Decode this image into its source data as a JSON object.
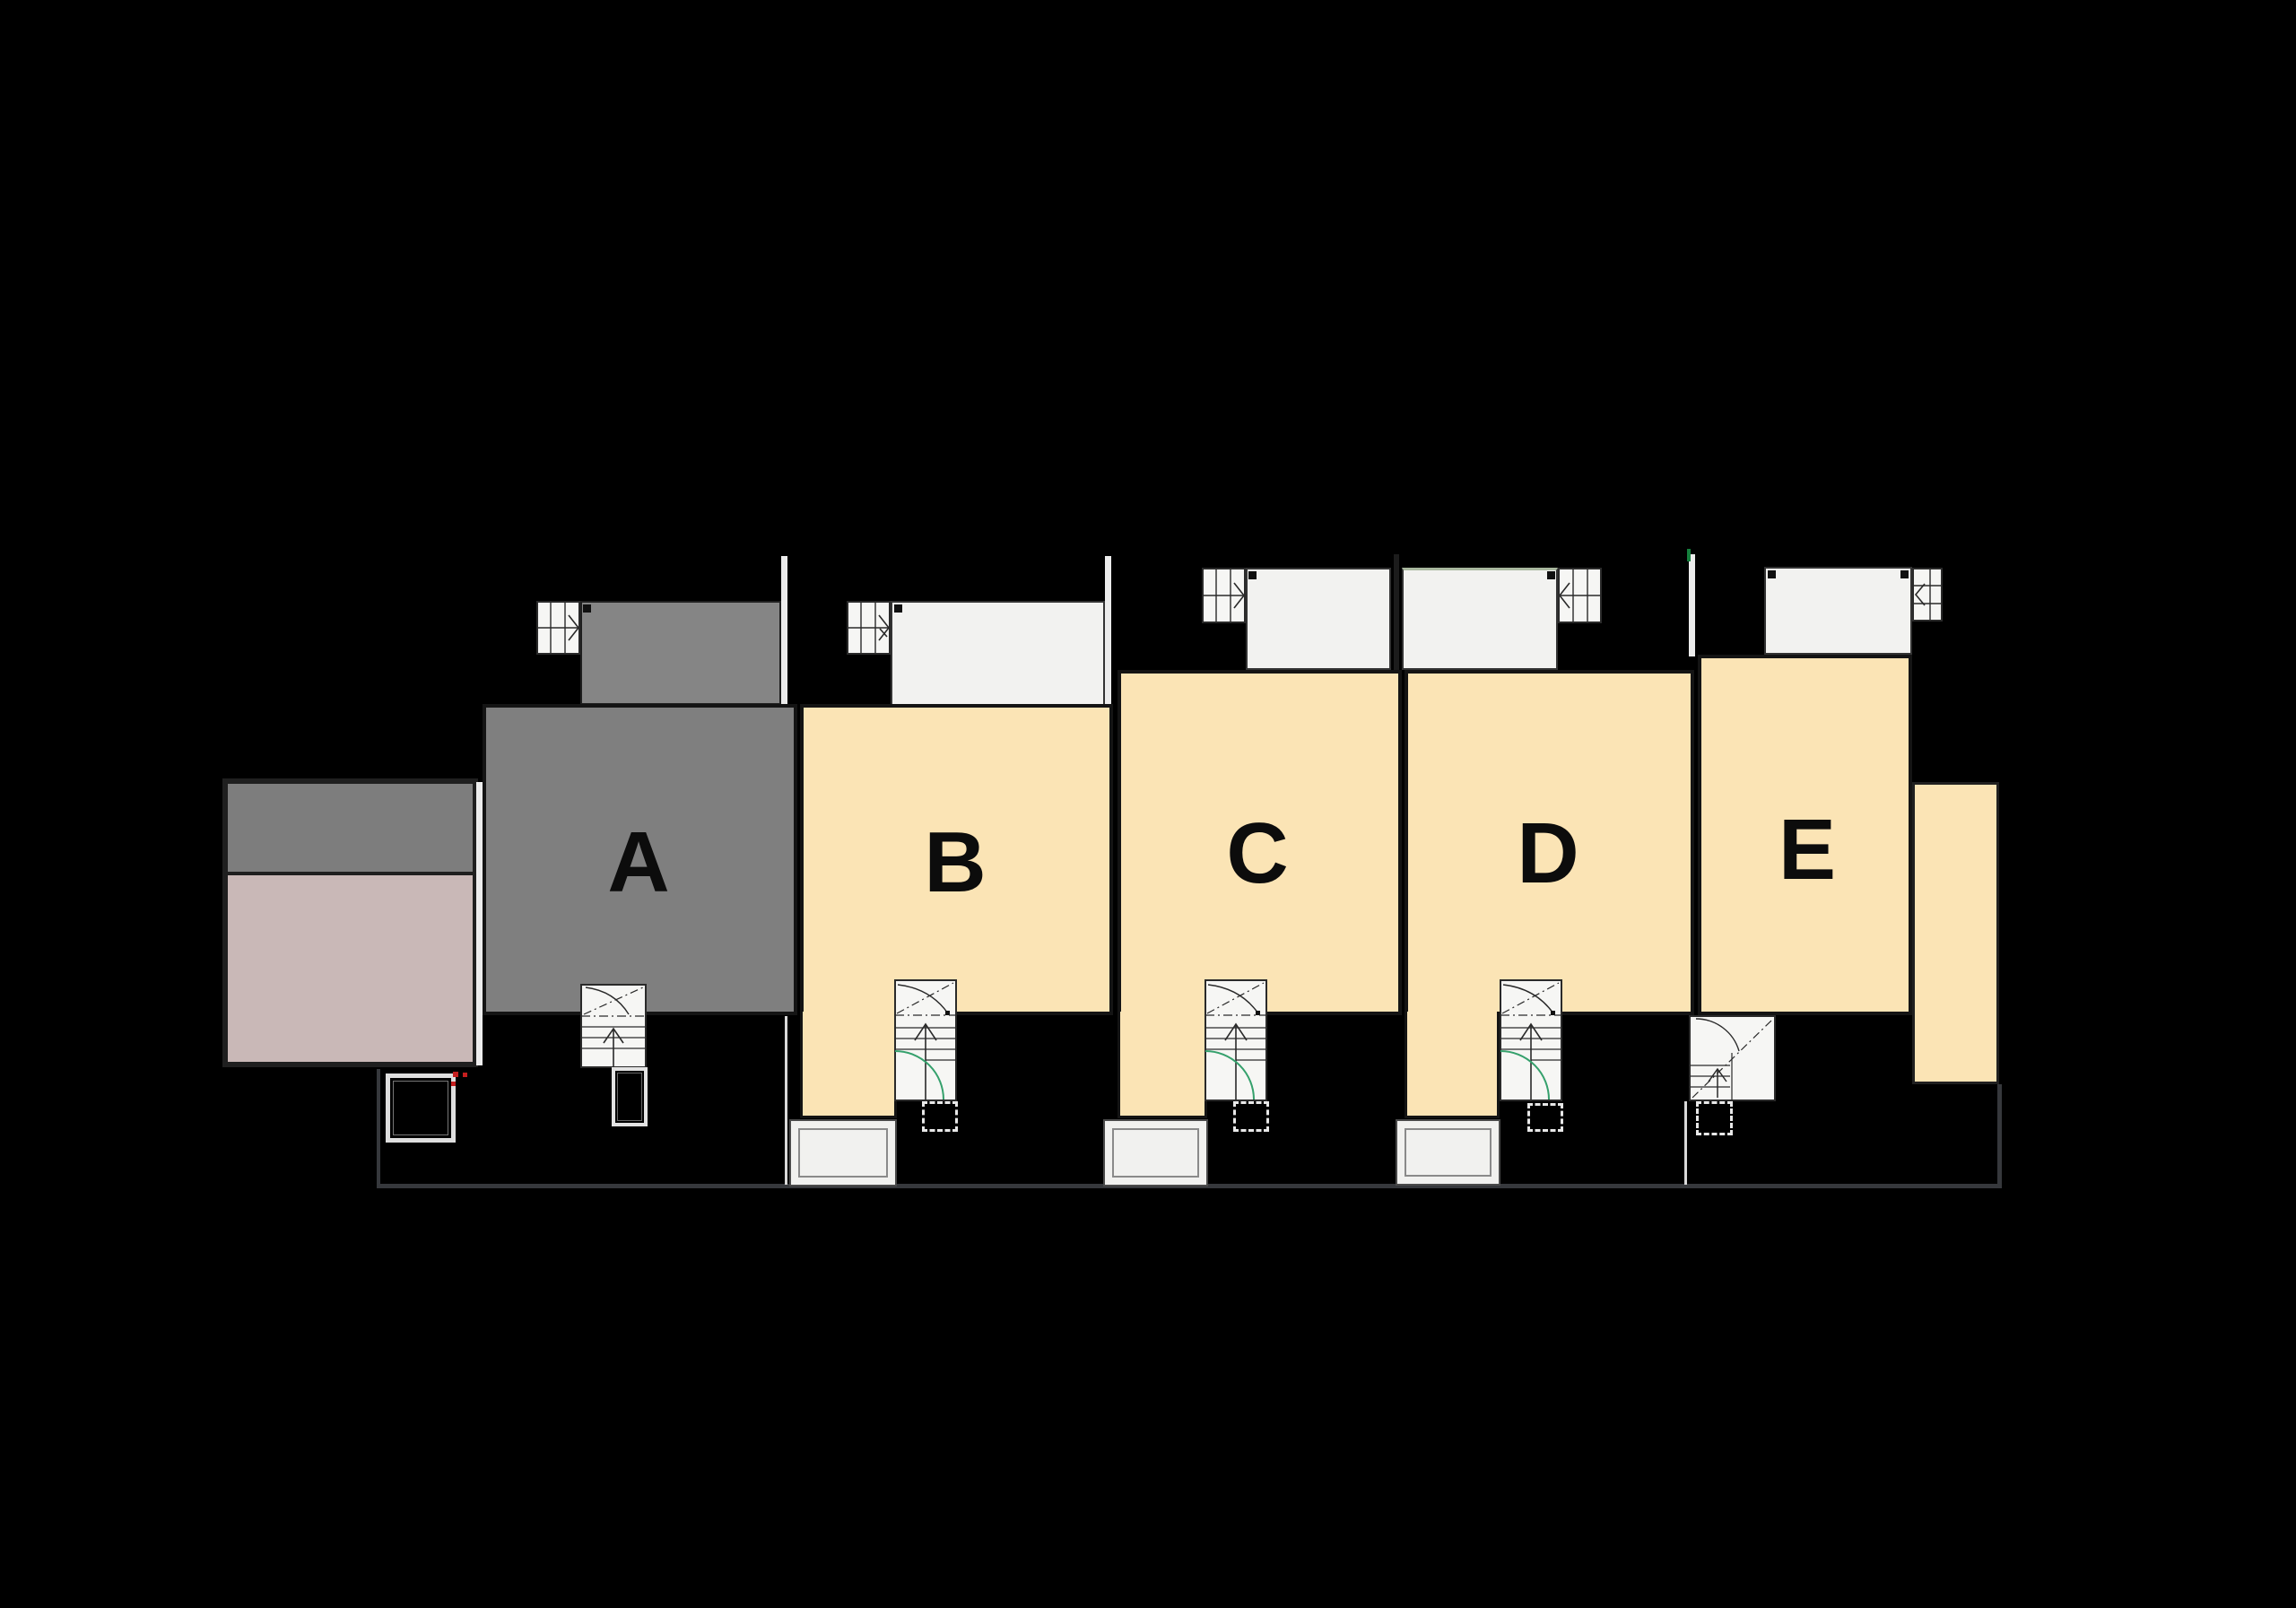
{
  "page": {
    "background": "#000000"
  },
  "site": {
    "boundary_color": "#36383c",
    "plot_divider_color": "#d9d9d9"
  },
  "palette": {
    "unit_tan": "#fbe4b5",
    "unit_gray": "#7f7f7f",
    "balcony_white": "#f2f2f0",
    "balcony_gray": "#858585",
    "balcony_sage_edge": "#a9b89f",
    "stair_white": "#f6f6f4",
    "outline_dark": "#141414",
    "annex_upper_gray": "#7d7d7d",
    "annex_lower_mauve": "#c9b8b7",
    "door_swing_green": "#35a06c",
    "survey_mark_green": "#15803d",
    "marker_red": "#c41e1e"
  },
  "units": [
    {
      "id": "a",
      "label": "A",
      "fill": "#7f7f7f"
    },
    {
      "id": "b",
      "label": "B",
      "fill": "#fbe4b5"
    },
    {
      "id": "c",
      "label": "C",
      "fill": "#fbe4b5"
    },
    {
      "id": "d",
      "label": "D",
      "fill": "#fbe4b5"
    },
    {
      "id": "e",
      "label": "E",
      "fill": "#fbe4b5"
    }
  ],
  "annex": {
    "upper_fill": "#7d7d7d",
    "lower_fill": "#c9b8b7"
  },
  "icons": {
    "up_arrow": "↑",
    "chevron_right": "❯",
    "chevron_left": "❮"
  }
}
